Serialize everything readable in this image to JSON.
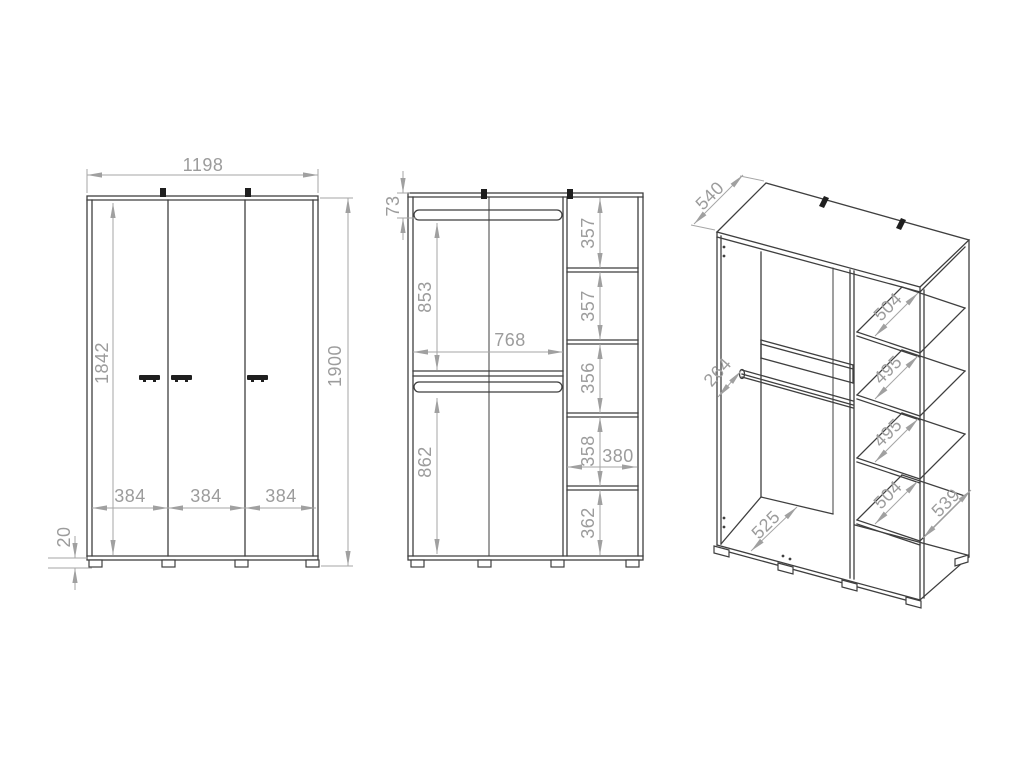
{
  "drawing": {
    "type": "wardrobe-technical-drawing",
    "colors": {
      "outline": "#3f3f3f",
      "dimension_line": "#a6a6a6",
      "dimension_text": "#9c9c9c",
      "background": "#ffffff"
    },
    "front_view": {
      "overall_width": "1198",
      "door_height": "1842",
      "overall_height": "1900",
      "door_widths": [
        "384",
        "384",
        "384"
      ],
      "plinth_height": "20"
    },
    "interior_view": {
      "rail_top_offset": "73",
      "upper_section_height": "853",
      "interior_width": "768",
      "lower_section_height": "862",
      "shelf_cells": [
        "357",
        "357",
        "356",
        "358",
        "362"
      ],
      "shelf_column_width": "380"
    },
    "perspective_view": {
      "overall_depth": "540",
      "rail_setback": "264",
      "shelf_depths": [
        "504",
        "495",
        "495",
        "504"
      ],
      "side_panel_depth": "539",
      "bottom_panel_depth": "525"
    }
  }
}
